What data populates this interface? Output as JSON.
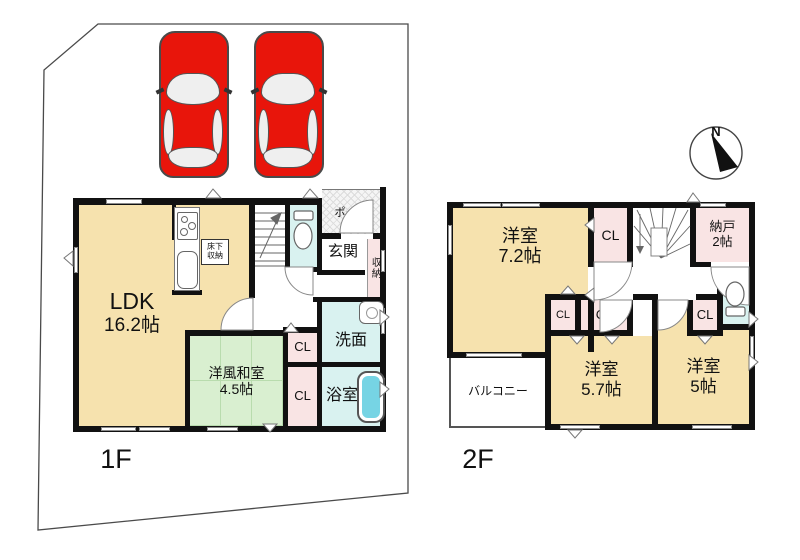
{
  "site": {
    "floor1_label": "1F",
    "floor2_label": "2F"
  },
  "compass": {
    "label": "N"
  },
  "floor1": {
    "ldk": {
      "name": "LDK",
      "size": "16.2帖"
    },
    "washitsu": {
      "name": "洋風和室",
      "size": "4.5帖"
    },
    "senmen": "洗面",
    "bathroom": "浴室",
    "closet_upper": "CL",
    "closet_lower": "CL",
    "genkan": "玄関",
    "storage": "収納",
    "porch": "ポーチ",
    "underfloor": {
      "line1": "床下",
      "line2": "収納"
    }
  },
  "floor2": {
    "bedroom1": {
      "name": "洋室",
      "size": "7.2帖"
    },
    "bedroom2": {
      "name": "洋室",
      "size": "5.7帖"
    },
    "bedroom3": {
      "name": "洋室",
      "size": "5帖"
    },
    "nando": {
      "name": "納戸",
      "size": "2帖"
    },
    "balcony": "バルコニー",
    "closet_top": "CL",
    "closet_a": "CL",
    "closet_b": "CL",
    "closet_c": "CL"
  },
  "icons": [
    "compass-icon",
    "car-icon",
    "toilet-icon",
    "bathtub-icon",
    "sink-icon",
    "stove-icon",
    "stairs-icon"
  ],
  "colors": {
    "room_cream": "#f6e2ae",
    "tatami_green": "#d9efd0",
    "water_cyan": "#d9f2f0",
    "closet_pink": "#f9e4e4",
    "car_red": "#e8150b",
    "tub_water": "#76d4e4",
    "wall_black": "#111111"
  }
}
